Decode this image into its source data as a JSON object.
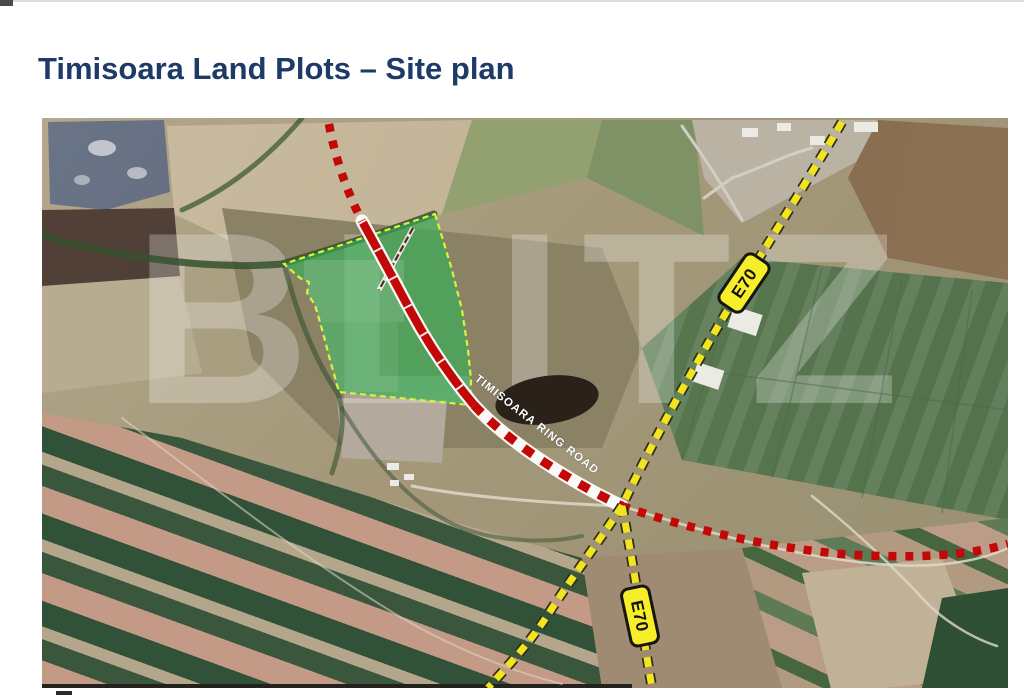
{
  "page": {
    "title": "Timisoara Land Plots – Site plan"
  },
  "map": {
    "watermark": "BLITZ",
    "ring_road_label": "TIMISOARA RING ROAD",
    "route_labels": [
      {
        "text": "E70"
      },
      {
        "text": "E70"
      }
    ]
  },
  "colors": {
    "title": "#1e3a66",
    "page_bg": "#ffffff",
    "plot_fill": "#2eb457",
    "plot_border": "#d9f23c",
    "road_red": "#c30808",
    "road_red_casing": "#ffffff",
    "road_yellow": "#f2e41f",
    "road_yellow_casing": "#2e2d20",
    "route_label_bg": "#f6ee28",
    "route_label_border": "#151515",
    "route_label_text": "#111111",
    "ring_road_text": "#ffffff",
    "watermark_text": "#ffffff"
  }
}
